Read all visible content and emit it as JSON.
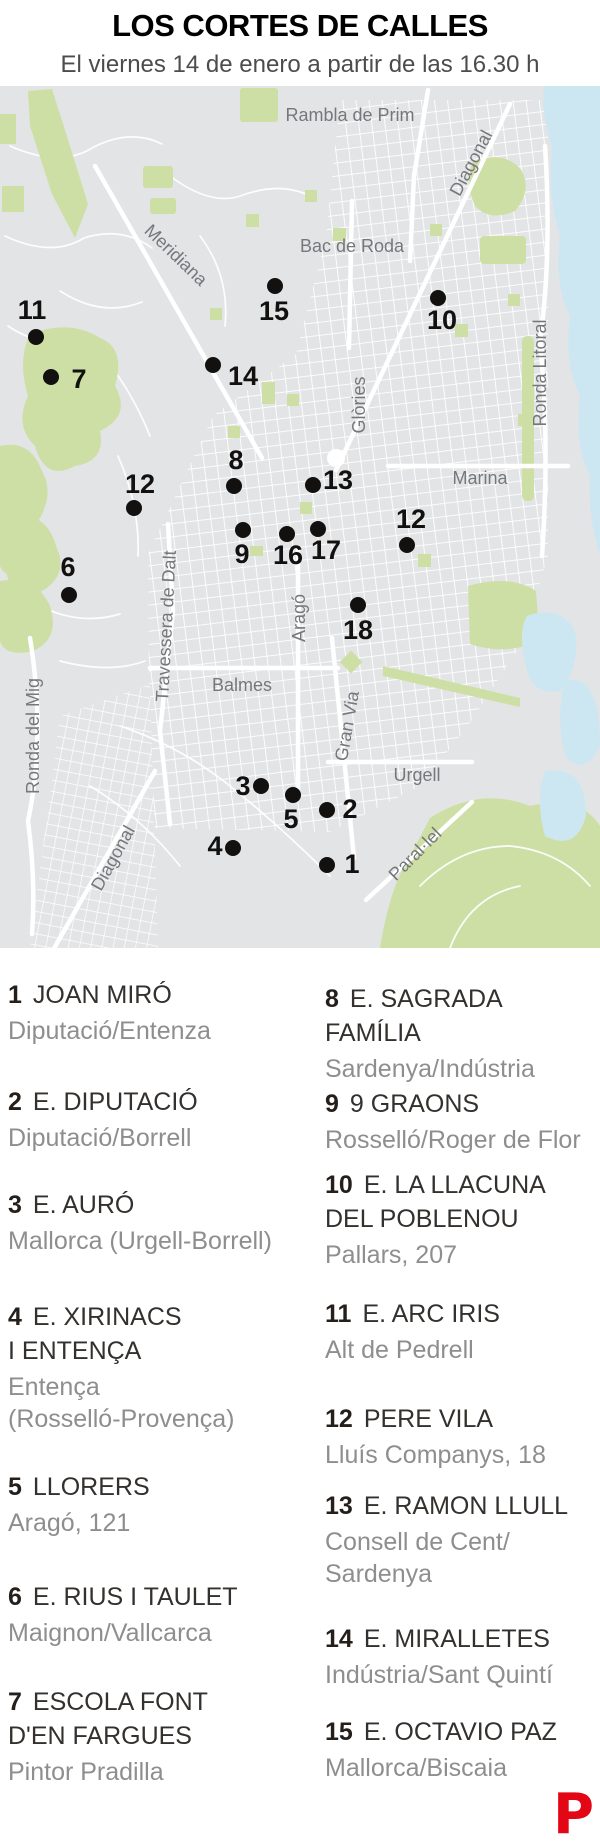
{
  "header": {
    "title": "LOS CORTES DE CALLES",
    "subtitle": "El viernes 14 de enero a partir de las 16.30 h"
  },
  "colors": {
    "land": "#e3e4e6",
    "park": "#cddfa5",
    "water": "#cde7f2",
    "street": "#ffffff",
    "marker": "#121110",
    "map_label": "#75787b",
    "logo_red": "#e30615"
  },
  "map": {
    "street_labels": [
      {
        "text": "Rambla de Prim",
        "x": 350,
        "y": 29,
        "rotate": 0
      },
      {
        "text": "Diagonal",
        "x": 471,
        "y": 77,
        "rotate": -62
      },
      {
        "text": "Meridiana",
        "x": 176,
        "y": 169,
        "rotate": 44
      },
      {
        "text": "Bac de Roda",
        "x": 352,
        "y": 160,
        "rotate": 0
      },
      {
        "text": "Ronda Litoral",
        "x": 540,
        "y": 287,
        "rotate": -90
      },
      {
        "text": "Glòries",
        "x": 359,
        "y": 319,
        "rotate": -90
      },
      {
        "text": "Marina",
        "x": 480,
        "y": 392,
        "rotate": 0
      },
      {
        "text": "Travessera de Dalt",
        "x": 166,
        "y": 540,
        "rotate": -87
      },
      {
        "text": "Aragó",
        "x": 299,
        "y": 532,
        "rotate": -90
      },
      {
        "text": "Balmes",
        "x": 242,
        "y": 599,
        "rotate": 0
      },
      {
        "text": "Gran Via",
        "x": 347,
        "y": 640,
        "rotate": -80
      },
      {
        "text": "Urgell",
        "x": 417,
        "y": 689,
        "rotate": 0
      },
      {
        "text": "Ronda del Mig",
        "x": 33,
        "y": 650,
        "rotate": -90
      },
      {
        "text": "Diagonal",
        "x": 113,
        "y": 772,
        "rotate": -61
      },
      {
        "text": "Paral·lel",
        "x": 415,
        "y": 768,
        "rotate": -45
      }
    ],
    "markers": [
      {
        "n": "1",
        "dot": [
          327,
          779
        ],
        "label": [
          352,
          778
        ]
      },
      {
        "n": "2",
        "dot": [
          327,
          724
        ],
        "label": [
          350,
          723
        ]
      },
      {
        "n": "3",
        "dot": [
          261,
          700
        ],
        "label": [
          243,
          700
        ]
      },
      {
        "n": "4",
        "dot": [
          233,
          762
        ],
        "label": [
          215,
          760
        ]
      },
      {
        "n": "5",
        "dot": [
          293,
          709
        ],
        "label": [
          291,
          733
        ]
      },
      {
        "n": "6",
        "dot": [
          69,
          509
        ],
        "label": [
          68,
          481
        ]
      },
      {
        "n": "7",
        "dot": [
          51,
          291
        ],
        "label": [
          79,
          293
        ]
      },
      {
        "n": "8",
        "dot": [
          234,
          400
        ],
        "label": [
          236,
          374
        ]
      },
      {
        "n": "9",
        "dot": [
          243,
          444
        ],
        "label": [
          242,
          468
        ]
      },
      {
        "n": "10",
        "dot": [
          438,
          212
        ],
        "label": [
          442,
          234
        ]
      },
      {
        "n": "11",
        "dot": [
          36,
          251
        ],
        "label": [
          32,
          224
        ]
      },
      {
        "n": "12",
        "dot": [
          134,
          422
        ],
        "label": [
          140,
          398
        ]
      },
      {
        "n": "12",
        "dot": [
          407,
          459
        ],
        "label": [
          411,
          433
        ]
      },
      {
        "n": "13",
        "dot": [
          313,
          399
        ],
        "label": [
          338,
          394
        ]
      },
      {
        "n": "14",
        "dot": [
          213,
          279
        ],
        "label": [
          243,
          290
        ]
      },
      {
        "n": "15",
        "dot": [
          275,
          200
        ],
        "label": [
          274,
          225
        ]
      },
      {
        "n": "16",
        "dot": [
          287,
          448
        ],
        "label": [
          288,
          469
        ]
      },
      {
        "n": "17",
        "dot": [
          318,
          443
        ],
        "label": [
          326,
          464
        ]
      },
      {
        "n": "18",
        "dot": [
          358,
          519
        ],
        "label": [
          358,
          544
        ]
      }
    ]
  },
  "legend": {
    "entries": [
      {
        "col": "left",
        "top": 978,
        "num": "1",
        "name": "JOAN MIRÓ",
        "sub": "Diputació/Entenza"
      },
      {
        "col": "left",
        "top": 1085,
        "num": "2",
        "name": "E. DIPUTACIÓ",
        "sub": "Diputació/Borrell"
      },
      {
        "col": "left",
        "top": 1188,
        "num": "3",
        "name": "E. AURÓ",
        "sub": "Mallorca (Urgell-Borrell)"
      },
      {
        "col": "left",
        "top": 1300,
        "num": "4",
        "name": "E. XIRINACS\nI ENTENÇA",
        "sub": "Entença\n(Rosselló-Provença)"
      },
      {
        "col": "left",
        "top": 1470,
        "num": "5",
        "name": "LLORERS",
        "sub": "Aragó, 121"
      },
      {
        "col": "left",
        "top": 1580,
        "num": "6",
        "name": "E. RIUS I TAULET",
        "sub": "Maignon/Vallcarca"
      },
      {
        "col": "left",
        "top": 1685,
        "num": "7",
        "name": "ESCOLA FONT\nD'EN FARGUES",
        "sub": "Pintor Pradilla"
      },
      {
        "col": "right",
        "top": 982,
        "num": "8",
        "name": "E. SAGRADA FAMÍLIA",
        "sub": "Sardenya/Indústria"
      },
      {
        "col": "right",
        "top": 1087,
        "num": "9",
        "name": "9 GRAONS",
        "sub": "Rosselló/Roger de Flor"
      },
      {
        "col": "right",
        "top": 1168,
        "num": "10",
        "name": "E. LA LLACUNA\nDEL POBLENOU",
        "sub": "Pallars, 207"
      },
      {
        "col": "right",
        "top": 1297,
        "num": "11",
        "name": "E. ARC IRIS",
        "sub": "Alt de Pedrell"
      },
      {
        "col": "right",
        "top": 1402,
        "num": "12",
        "name": "PERE VILA",
        "sub": "Lluís Companys, 18"
      },
      {
        "col": "right",
        "top": 1489,
        "num": "13",
        "name": "E. RAMON LLULL",
        "sub": "Consell de Cent/\nSardenya"
      },
      {
        "col": "right",
        "top": 1622,
        "num": "14",
        "name": "E. MIRALLETES",
        "sub": "Indústria/Sant Quintí"
      },
      {
        "col": "right",
        "top": 1715,
        "num": "15",
        "name": "E. OCTAVIO PAZ",
        "sub": "Mallorca/Biscaia"
      }
    ]
  },
  "footer": {
    "logo_letter": "P"
  }
}
